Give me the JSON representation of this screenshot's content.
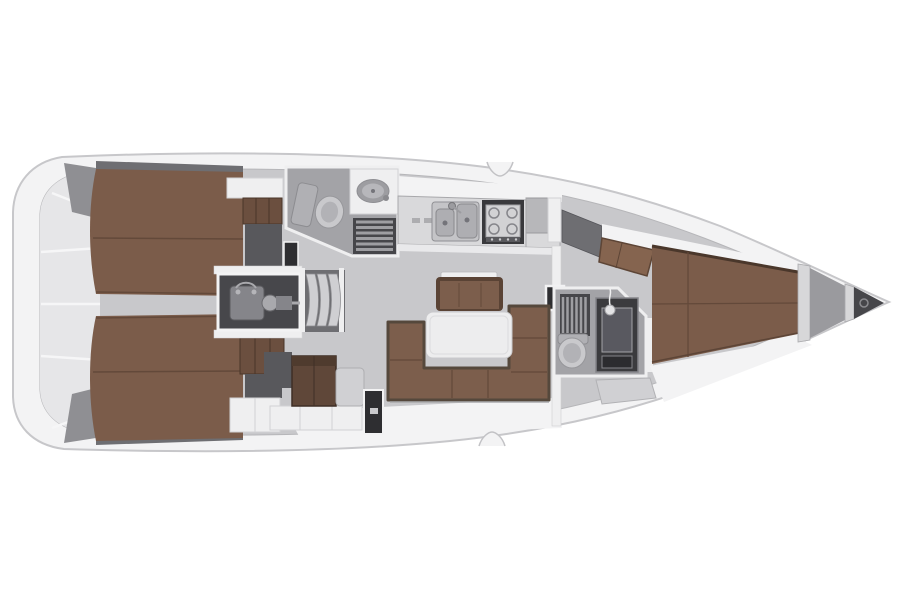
{
  "figure": {
    "type": "sailing-yacht-interior-floor-plan",
    "view": "top-down",
    "bow_direction": "right",
    "stern_direction": "left",
    "areas": [
      "stern-lazarette",
      "aft-cabin-starboard",
      "aft-cabin-port",
      "engine-compartment",
      "companionway-steps",
      "aft-head",
      "galley",
      "salon",
      "forward-head",
      "forward-cabin",
      "anchor-locker"
    ],
    "fixtures": [
      "double-berth-starboard",
      "double-berth-port",
      "toilet-aft",
      "washbasin-aft",
      "shower-grate-aft",
      "double-sink",
      "stove",
      "salon-table",
      "u-settee",
      "sideboard-bench",
      "engine",
      "toilet-forward",
      "shower-grate-forward",
      "vanity-mirror",
      "v-berth",
      "bow-roller"
    ]
  },
  "colors": {
    "background": "#ffffff",
    "hull": "#f3f3f4",
    "hull_line": "#c7c7ca",
    "floor": "#c8c8cb",
    "floor_line": "#b6b6b9",
    "stern_panel": "#e6e6e8",
    "stern_divider": "#f6f6f7",
    "stern_wedge": "#8f8f93",
    "liner": "#6e6e72",
    "wall": "#efeff0",
    "wall_line": "#d2d2d4",
    "berth": "#7b5c4a",
    "berth_edge": "#4a372b",
    "berth_seam": "#63493a",
    "wardrobe": "#6b4f3f",
    "wardrobe_line": "#4a3628",
    "cabinet": "#5f4739",
    "panel_dark": "#58585c",
    "door_dark": "#2e2e31",
    "seat_light": "#d0d0d3",
    "settee": "#7c5e4c",
    "settee_rim": "#55483c",
    "settee_seam": "#63493a",
    "bench_base": "#5a4335",
    "wedge_seat": "#85644f",
    "wedge_line": "#5d4536",
    "table_white": "#ededee",
    "table_line": "#c9c9cc",
    "engine_box": "#47474b",
    "engine_part": "#85858a",
    "engine_part_light": "#a9a9ad",
    "engine_line": "#5a5a5e",
    "step": "#cfcfd2",
    "step_line": "#8f8f93",
    "head_floor": "#a3a3a7",
    "fixture": "#c9c9cc",
    "fixture_inner": "#b2b2b6",
    "fixture_dark": "#b0b0b4",
    "fixture_line": "#97979b",
    "basin": "#9d9da1",
    "basin_inner": "#b7b7bb",
    "grate": "#46464a",
    "grate_slat": "#9e9ea2",
    "counter": "#d9d9db",
    "counter_front": "#e9e9eb",
    "counter_line": "#a8a8ab",
    "latch": "#adadb0",
    "sink_steel": "#c4c4c7",
    "sink_inner": "#aeaeb2",
    "sink_line": "#8a8a8e",
    "drain": "#74747a",
    "stove_frame": "#39393c",
    "stove_panel": "#d2d2d4",
    "burner": "#85858a",
    "knob_strip": "#5a5a5e",
    "knob_dot": "#c9c9cc",
    "fridge_panel": "#b7b7ba",
    "vanity": "#3b3b3e",
    "mirror": "#595960",
    "drawer": "#2c2c2f",
    "shower": "#e4e4e6",
    "bow_floor": "#9a9a9e",
    "bow_bar": "#d7d7d9",
    "bow_dark": "#46464a",
    "roller": "#8b8b8f"
  }
}
